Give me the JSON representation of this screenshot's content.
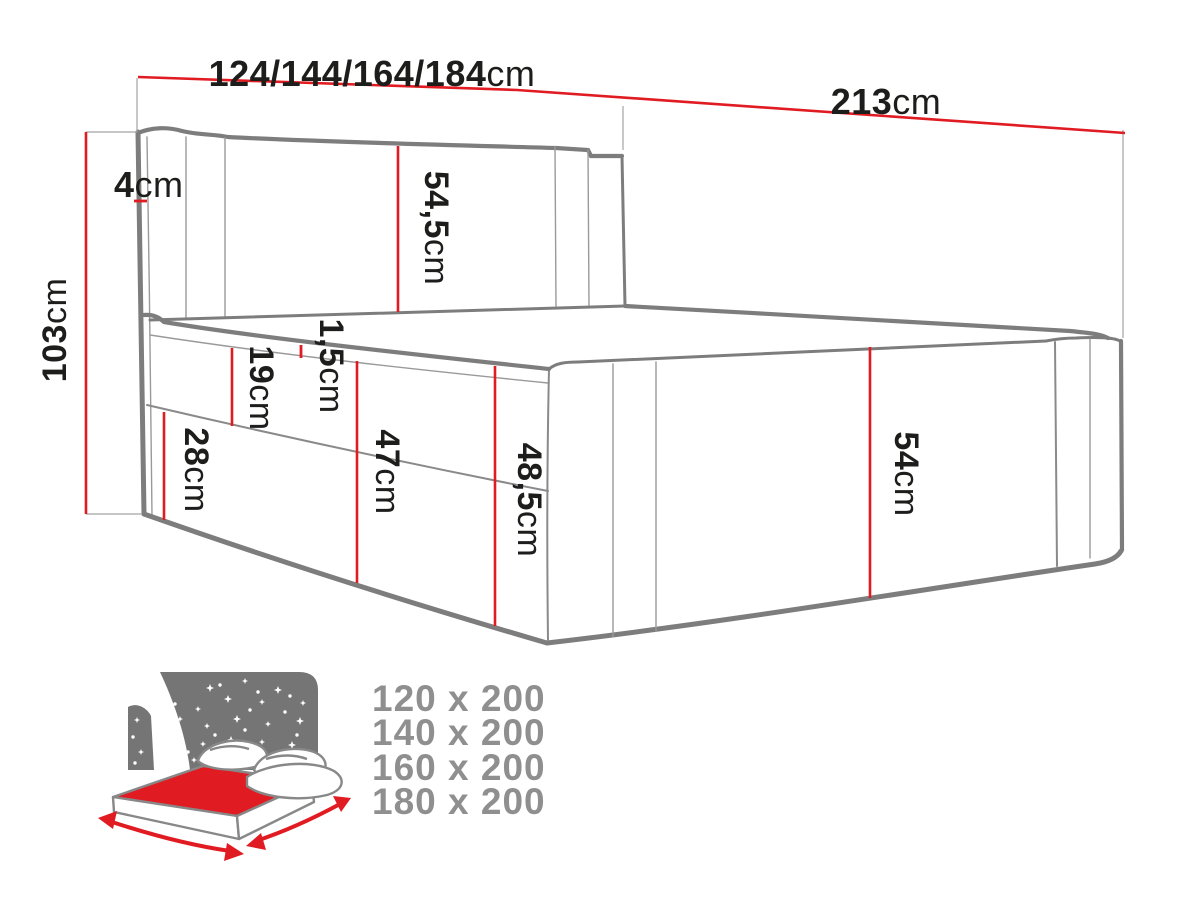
{
  "colors": {
    "dimension_red": "#e11b22",
    "outline_gray": "#7d7d7d",
    "sky_gray": "#757575",
    "size_text_gray": "#8f8f8f",
    "label_black": "#1d1d1b",
    "icon_mattress_red": "#e11b22",
    "background": "#ffffff"
  },
  "dimensions": {
    "width_options": {
      "value": "124/144/164/184",
      "unit": "cm"
    },
    "length": {
      "value": "213",
      "unit": "cm"
    },
    "total_height": {
      "value": "103",
      "unit": "cm"
    },
    "headboard_thickness": {
      "value": "4",
      "unit": "cm"
    },
    "headboard_above": {
      "value": "54,5",
      "unit": "cm"
    },
    "topper_height": {
      "value": "1,5",
      "unit": "cm"
    },
    "mattress_height": {
      "value": "19",
      "unit": "cm"
    },
    "base_height": {
      "value": "28",
      "unit": "cm"
    },
    "side_height": {
      "value": "47",
      "unit": "cm"
    },
    "side_total_height": {
      "value": "48,5",
      "unit": "cm"
    },
    "foot_height": {
      "value": "54",
      "unit": "cm"
    }
  },
  "size_variants": [
    "120 x 200",
    "140 x 200",
    "160 x 200",
    "180 x 200"
  ]
}
